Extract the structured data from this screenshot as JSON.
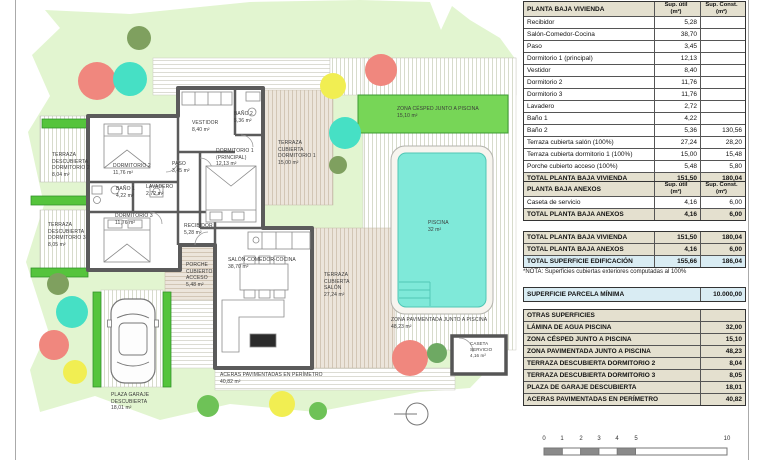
{
  "plan": {
    "labels": {
      "terraza_desc_dorm2": "TERRAZA\nDESCUBIERTA\nDORMITORIO 2\n8,04 m²",
      "terraza_desc_dorm3": "TERRAZA\nDESCUBIERTA\nDORMITORIO 3\n8,05 m²",
      "dormitorio2": "DORMITORIO 2\n11,76 m²",
      "bano1": "BAÑO 1\n4,22 m²",
      "lavadero": "LAVADERO\n2,72 m²",
      "dormitorio3": "DORMITORIO 3\n11,76 m²",
      "vestidor": "VESTIDOR\n8,40 m²",
      "bano2": "BAÑO 2\n5,36 m²",
      "dormitorio1": "DORMITORIO 1\n(PRINCIPAL)\n12,13 m²",
      "paso": "PASO\n3,45 m²",
      "terraza_cub_dorm1": "TERRAZA\nCUBIERTA\nDORMITORIO 1\n15,00 m²",
      "recibidor": "RECIBIDOR\n5,28 m²",
      "porche": "PORCHE\nCUBIERTO\nACCESO\n5,48 m²",
      "salon": "SALÓN-COMEDOR-COCINA\n38,70 m²",
      "terraza_cub_salon": "TERRAZA\nCUBIERTA\nSALÓN\n27,24 m²",
      "zona_cesped": "ZONA CÉSPED JUNTO A PISCINA\n15,10 m²",
      "piscina": "PISCINA\n32 m²",
      "zona_pavimentada": "ZONA PAVIMENTADA JUNTO A PISCINA\n48,23 m²",
      "aceras": "ACERAS PAVIMENTADAS EN PERÍMETRO\n40,82 m²",
      "plaza_garaje": "PLAZA GARAJE\nDESCUBIERTA\n18,01 m²",
      "caseta": "CASETA\nSERVICIO\n4,16 m²"
    },
    "scale_ticks": {
      "t0": "0",
      "t1": "1",
      "t2": "2",
      "t3": "3",
      "t4": "4",
      "t5": "5",
      "t10": "10"
    }
  },
  "tables": {
    "vivienda": {
      "title": "PLANTA BAJA VIVIENDA",
      "col_util": "Sup. útil\n(m²)",
      "col_const": "Sup. Const.\n(m²)",
      "rows": [
        {
          "label": "Recibidor",
          "util": "5,28",
          "const": ""
        },
        {
          "label": "Salón-Comedor-Cocina",
          "util": "38,70",
          "const": ""
        },
        {
          "label": "Paso",
          "util": "3,45",
          "const": ""
        },
        {
          "label": "Dormitorio 1 (principal)",
          "util": "12,13",
          "const": ""
        },
        {
          "label": "Vestidor",
          "util": "8,40",
          "const": ""
        },
        {
          "label": "Dormitorio 2",
          "util": "11,76",
          "const": ""
        },
        {
          "label": "Dormitorio 3",
          "util": "11,76",
          "const": ""
        },
        {
          "label": "Lavadero",
          "util": "2,72",
          "const": ""
        },
        {
          "label": "Baño 1",
          "util": "4,22",
          "const": ""
        },
        {
          "label": "Baño 2",
          "util": "5,36",
          "const": "130,56"
        },
        {
          "label": "Terraza cubierta salón (100%)",
          "util": "27,24",
          "const": "28,20"
        },
        {
          "label": "Terraza cubierta dormitorio 1 (100%)",
          "util": "15,00",
          "const": "15,48"
        },
        {
          "label": "Porche cubierto acceso (100%)",
          "util": "5,48",
          "const": "5,80"
        }
      ],
      "total": {
        "label": "TOTAL PLANTA BAJA VIVIENDA",
        "util": "151,50",
        "const": "180,04"
      }
    },
    "anexos": {
      "title": "PLANTA BAJA ANEXOS",
      "col_util": "Sup. útil\n(m²)",
      "col_const": "Sup. Const.\n(m²)",
      "rows": [
        {
          "label": "Caseta de servicio",
          "util": "4,16",
          "const": "6,00"
        }
      ],
      "total": {
        "label": "TOTAL PLANTA BAJA ANEXOS",
        "util": "4,16",
        "const": "6,00"
      }
    },
    "resumen": {
      "rows": [
        {
          "label": "TOTAL PLANTA BAJA VIVIENDA",
          "util": "151,50",
          "const": "180,04"
        },
        {
          "label": "TOTAL PLANTA BAJA ANEXOS",
          "util": "4,16",
          "const": "6,00"
        },
        {
          "label": "TOTAL SUPERFICIE EDIFICACIÓN",
          "util": "155,66",
          "const": "186,04"
        }
      ],
      "nota": "*NOTA: Superficies cubiertas exteriores computadas al 100%"
    },
    "parcela": {
      "label": "SUPERFICIE PARCELA MÍNIMA",
      "value": "10.000,00"
    },
    "otras": {
      "title": "OTRAS SUPERFICIES",
      "rows": [
        {
          "label": "LÁMINA DE AGUA PISCINA",
          "value": "32,00"
        },
        {
          "label": "ZONA CÉSPED JUNTO A PISCINA",
          "value": "15,10"
        },
        {
          "label": "ZONA PAVIMENTADA JUNTO A PISCINA",
          "value": "48,23"
        },
        {
          "label": "TERRAZA DESCUBIERTA DORMITORIO 2",
          "value": "8,04"
        },
        {
          "label": "TERRAZA DESCUBIERTA DORMITORIO 3",
          "value": "8,05"
        },
        {
          "label": "PLAZA DE GARAJE DESCUBIERTA",
          "value": "18,01"
        },
        {
          "label": "ACERAS PAVIMENTADAS EN PERÍMETRO",
          "value": "40,82"
        }
      ]
    }
  }
}
